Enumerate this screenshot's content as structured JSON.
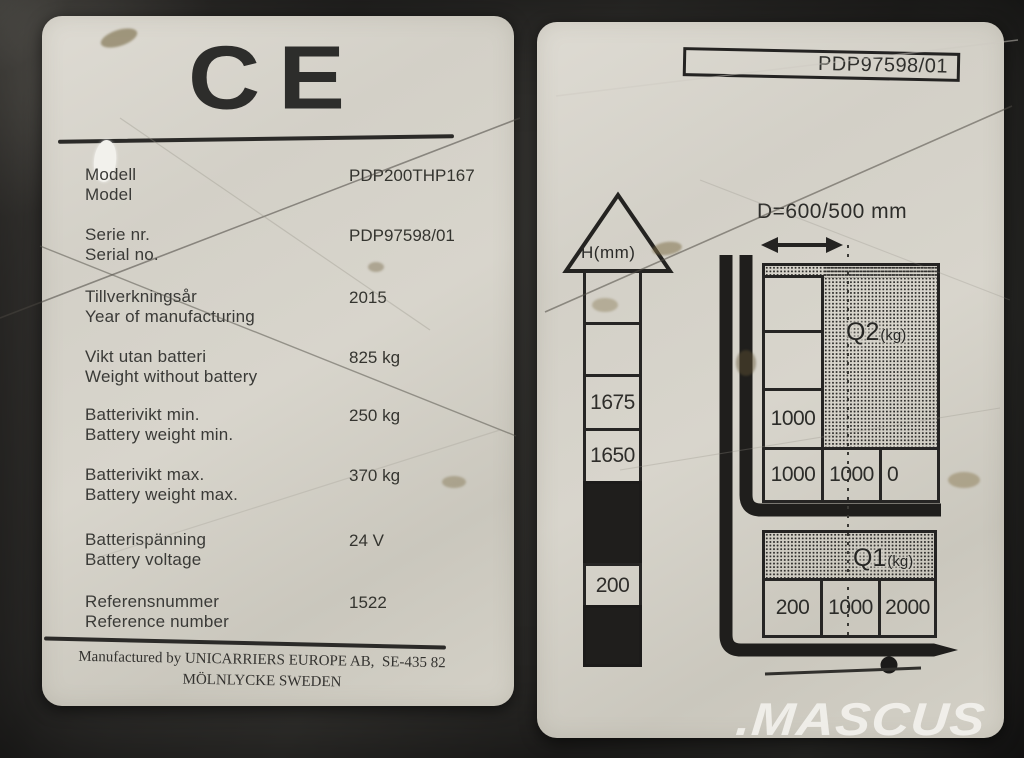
{
  "colors": {
    "plate_background": "#d5d2c9",
    "ink": "#2d2d2b",
    "photo_background": "#2b2a28",
    "watermark": "#f7f6f3"
  },
  "watermark_text": ".MASCUS",
  "left_label": {
    "ce_mark": "CE",
    "rows": [
      {
        "sv": "Modell",
        "en": "Model",
        "value": "PDP200THP167"
      },
      {
        "sv": "Serie nr.",
        "en": "Serial no.",
        "value": "PDP97598/01"
      },
      {
        "sv": "Tillverkningsår",
        "en": "Year of manufacturing",
        "value": "2015"
      },
      {
        "sv": "Vikt utan batteri",
        "en": "Weight without battery",
        "value": "825 kg"
      },
      {
        "sv": "Batterivikt min.",
        "en": "Battery weight min.",
        "value": "250 kg"
      },
      {
        "sv": "Batterivikt max.",
        "en": "Battery weight max.",
        "value": "370 kg"
      },
      {
        "sv": "Batterispänning",
        "en": "Battery voltage",
        "value": "24 V"
      },
      {
        "sv": "Referensnummer",
        "en": "Reference number",
        "value": "1522"
      }
    ],
    "manufacturer_line1": "Manufactured by UNICARRIERS EUROPE AB,  SE-435 82",
    "manufacturer_line2": "MÖLNLYCKE SWEDEN"
  },
  "right_label": {
    "plate_number": "PDP97598/01",
    "d_dimension": "D=600/500 mm",
    "h_column": {
      "label": "H(mm)",
      "cells": [
        "",
        "",
        "1675",
        "1650",
        "",
        "200",
        ""
      ]
    },
    "q2_table": {
      "name": "Q2",
      "unit": "(kg)",
      "left_column": [
        "",
        "",
        "1000"
      ],
      "bottom_row": [
        "1000",
        "1000",
        "0"
      ]
    },
    "q1_table": {
      "name": "Q1",
      "unit": "(kg)",
      "bottom_row": [
        "200",
        "1000",
        "2000"
      ]
    }
  }
}
